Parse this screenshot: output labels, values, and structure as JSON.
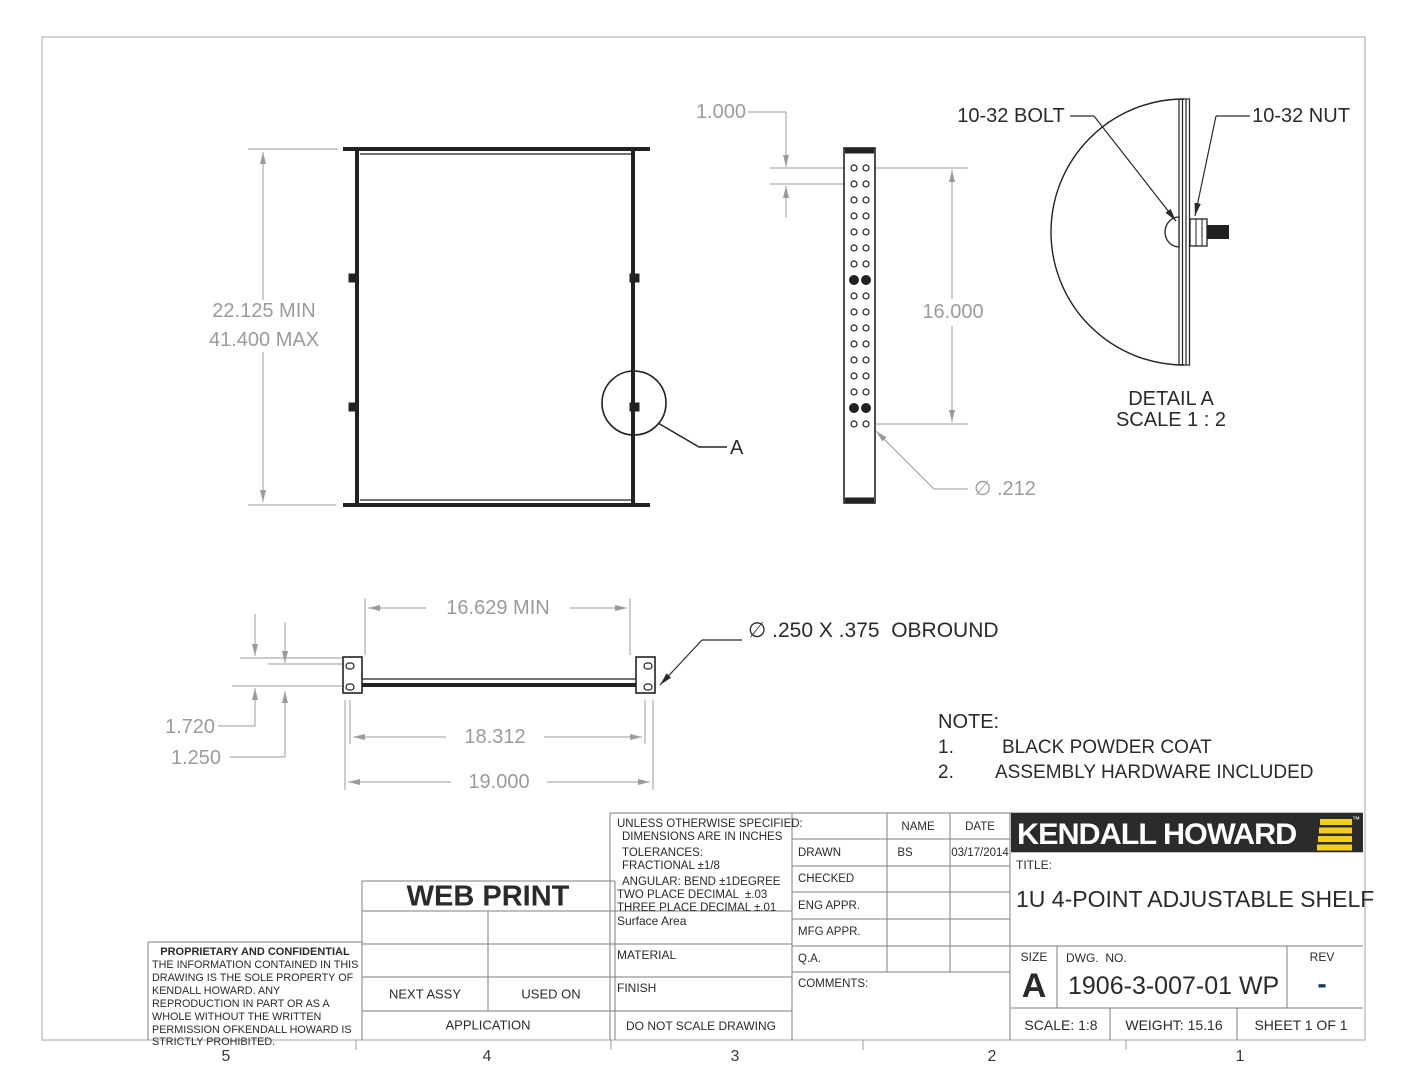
{
  "sheet": {
    "zones": [
      "5",
      "4",
      "3",
      "2",
      "1"
    ]
  },
  "views": {
    "front": {
      "height_min": "22.125 MIN",
      "height_max": "41.400 MAX",
      "detail_tag": "A"
    },
    "side": {
      "hole_pitch": "1.000",
      "span": "16.000",
      "hole_dia": "∅ .212"
    },
    "detail_a": {
      "bolt": "10-32 BOLT",
      "nut": "10-32 NUT",
      "name": "DETAIL A",
      "scale": "SCALE 1 : 2"
    },
    "bottom": {
      "inner_min": "16.629 MIN",
      "mid": "18.312",
      "outer": "19.000",
      "left_upper": "1.720",
      "left_lower": "1.250",
      "slot": "∅ .250 X .375  OBROUND"
    }
  },
  "note": {
    "heading": "NOTE:",
    "items": [
      {
        "n": "1.",
        "text": "BLACK POWDER COAT"
      },
      {
        "n": "2.",
        "text": "ASSEMBLY HARDWARE INCLUDED"
      }
    ]
  },
  "title_block": {
    "proprietary": {
      "heading": "PROPRIETARY AND CONFIDENTIAL",
      "body": "THE INFORMATION CONTAINED IN THIS DRAWING IS THE SOLE PROPERTY OF KENDALL HOWARD.  ANY REPRODUCTION IN PART OR AS A WHOLE WITHOUT THE WRITTEN PERMISSION OFKENDALL HOWARD IS STRICTLY PROHIBITED."
    },
    "stamp": "WEB PRINT",
    "application": {
      "next_assy": "NEXT ASSY",
      "used_on": "USED ON",
      "label": "APPLICATION"
    },
    "tolerances": {
      "l1": "UNLESS OTHERWISE SPECIFIED:",
      "l2": "DIMENSIONS ARE IN INCHES",
      "l3": "TOLERANCES:",
      "l4": "FRACTIONAL ±1/8",
      "l5": "ANGULAR: BEND ±1DEGREE",
      "l6": "TWO PLACE DECIMAL  ±.03",
      "l7": "THREE PLACE DECIMAL ±.01"
    },
    "fields": {
      "surface_area": "Surface Area",
      "material": "MATERIAL",
      "finish": "FINISH",
      "do_not_scale": "DO NOT SCALE DRAWING"
    },
    "approvals": {
      "name_header": "NAME",
      "date_header": "DATE",
      "rows": [
        {
          "label": "DRAWN",
          "name": "BS",
          "date": "03/17/2014"
        },
        {
          "label": "CHECKED",
          "name": "",
          "date": ""
        },
        {
          "label": "ENG APPR.",
          "name": "",
          "date": ""
        },
        {
          "label": "MFG APPR.",
          "name": "",
          "date": ""
        },
        {
          "label": "Q.A.",
          "name": "",
          "date": ""
        }
      ],
      "comments": "COMMENTS:"
    },
    "brand": {
      "logo": "KENDALL HOWARD",
      "tm": "™"
    },
    "title_label": "TITLE:",
    "title": "1U 4-POINT ADJUSTABLE SHELF",
    "size_label": "SIZE",
    "size": "A",
    "dwg_label": "DWG.  NO.",
    "dwg_no": "1906-3-007-01 WP",
    "rev_label": "REV",
    "rev": "-",
    "scale": "SCALE: 1:8",
    "weight": "WEIGHT: 15.16",
    "sheet": "SHEET 1 OF 1",
    "colors": {
      "accent_yellow": "#f2cf1d",
      "rev_blue": "#17365d",
      "line_black": "#222222",
      "dim_gray": "#9b9b9b"
    }
  }
}
